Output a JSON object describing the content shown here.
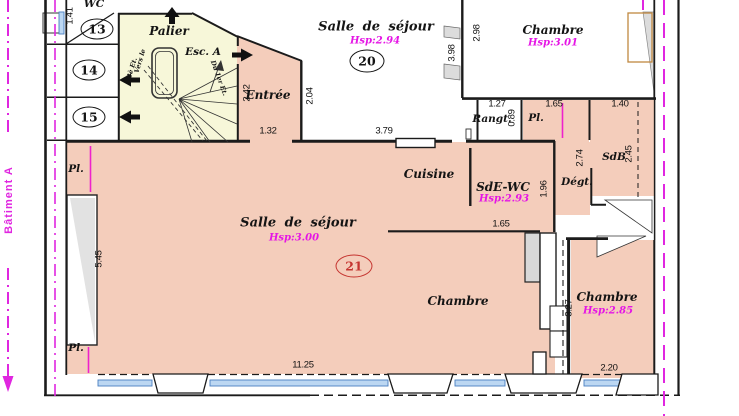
{
  "labels": {
    "building": "Bâtiment A",
    "wc": "WC",
    "palier": "Palier",
    "esc_a": "Esc. A",
    "vers_le": "Vers le",
    "et3": "3è Et.",
    "du_1er": "Du 1er Et.",
    "entree": "Entrée",
    "badge13": "13",
    "badge14": "14",
    "badge15": "15",
    "badge20": "20",
    "badge21": "21",
    "sejour20": "Salle de séjour",
    "sejour20_hsp": "Hsp:2.94",
    "chambre_tr": "Chambre",
    "chambre_tr_hsp": "Hsp:3.01",
    "rangt": "Rangt.",
    "pl_top": "Pl.",
    "sdb": "SdB",
    "degt": "Dégt.",
    "cuisine": "Cuisine",
    "sde_wc": "SdE-WC",
    "sde_wc_hsp": "Hsp:2.93",
    "sejour21": "Salle de séjour",
    "sejour21_hsp": "Hsp:3.00",
    "chambre_bl": "Chambre",
    "chambre_br": "Chambre",
    "chambre_br_hsp": "Hsp:2.85",
    "pl_left_top": "Pl.",
    "pl_left_bottom": "Pl."
  },
  "dimensions": {
    "left_wc": "1.41",
    "entree_w": "2.42",
    "sejour20_left": "2.04",
    "entree_opening": "1.32",
    "sejour20_bottom": "3.79",
    "sejour20_right": "3.98",
    "chambre_tr_left": "2.98",
    "rangt_w": "1.27",
    "rangt_h": "0.89",
    "pl_w": "1.65",
    "sdb_w": "1.40",
    "degt_h": "2.74",
    "sdb_h": "2.45",
    "sde_wc_h": "1.96",
    "sde_wc_w": "1.65",
    "sejour21_left": "5.45",
    "chambre_br_h": "3.27",
    "sejour21_bottom": "11.25",
    "chambre_br_w": "2.20"
  },
  "colors": {
    "room_fill": "#f4cdbb",
    "stair_fill": "#f7f7d9",
    "boundary_magenta": "#e026e0",
    "hsp_text": "#e516e5",
    "badge21_red": "#c53530",
    "window_blue": "#bcd7f2",
    "wall": "#1b1b1b",
    "door_frame": "#c08840"
  }
}
